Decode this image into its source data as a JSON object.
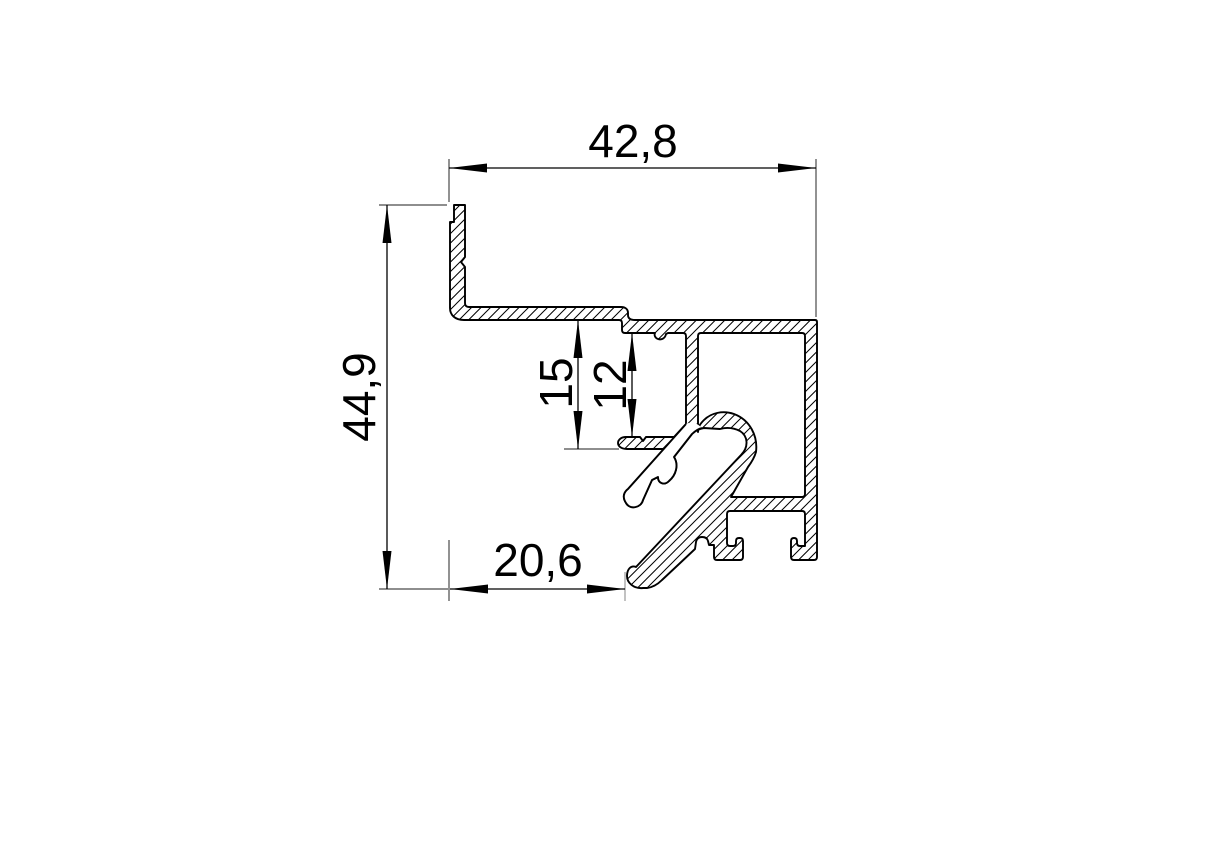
{
  "drawing": {
    "kind": "aluminium-profile-cross-section",
    "background": "#ffffff",
    "line_color": "#000000",
    "extension_line_color": "#4a4a4a",
    "hatch": {
      "angle_deg": 45,
      "spacing_px": 9.5
    },
    "dimensions": [
      {
        "id": "width-top",
        "label": "42,8",
        "orientation": "horizontal"
      },
      {
        "id": "height-left",
        "label": "44,9",
        "orientation": "vertical"
      },
      {
        "id": "groove-depth-outer",
        "label": "15",
        "orientation": "vertical"
      },
      {
        "id": "groove-depth-inner",
        "label": "12",
        "orientation": "vertical"
      },
      {
        "id": "width-bottom",
        "label": "20,6",
        "orientation": "horizontal"
      }
    ]
  }
}
